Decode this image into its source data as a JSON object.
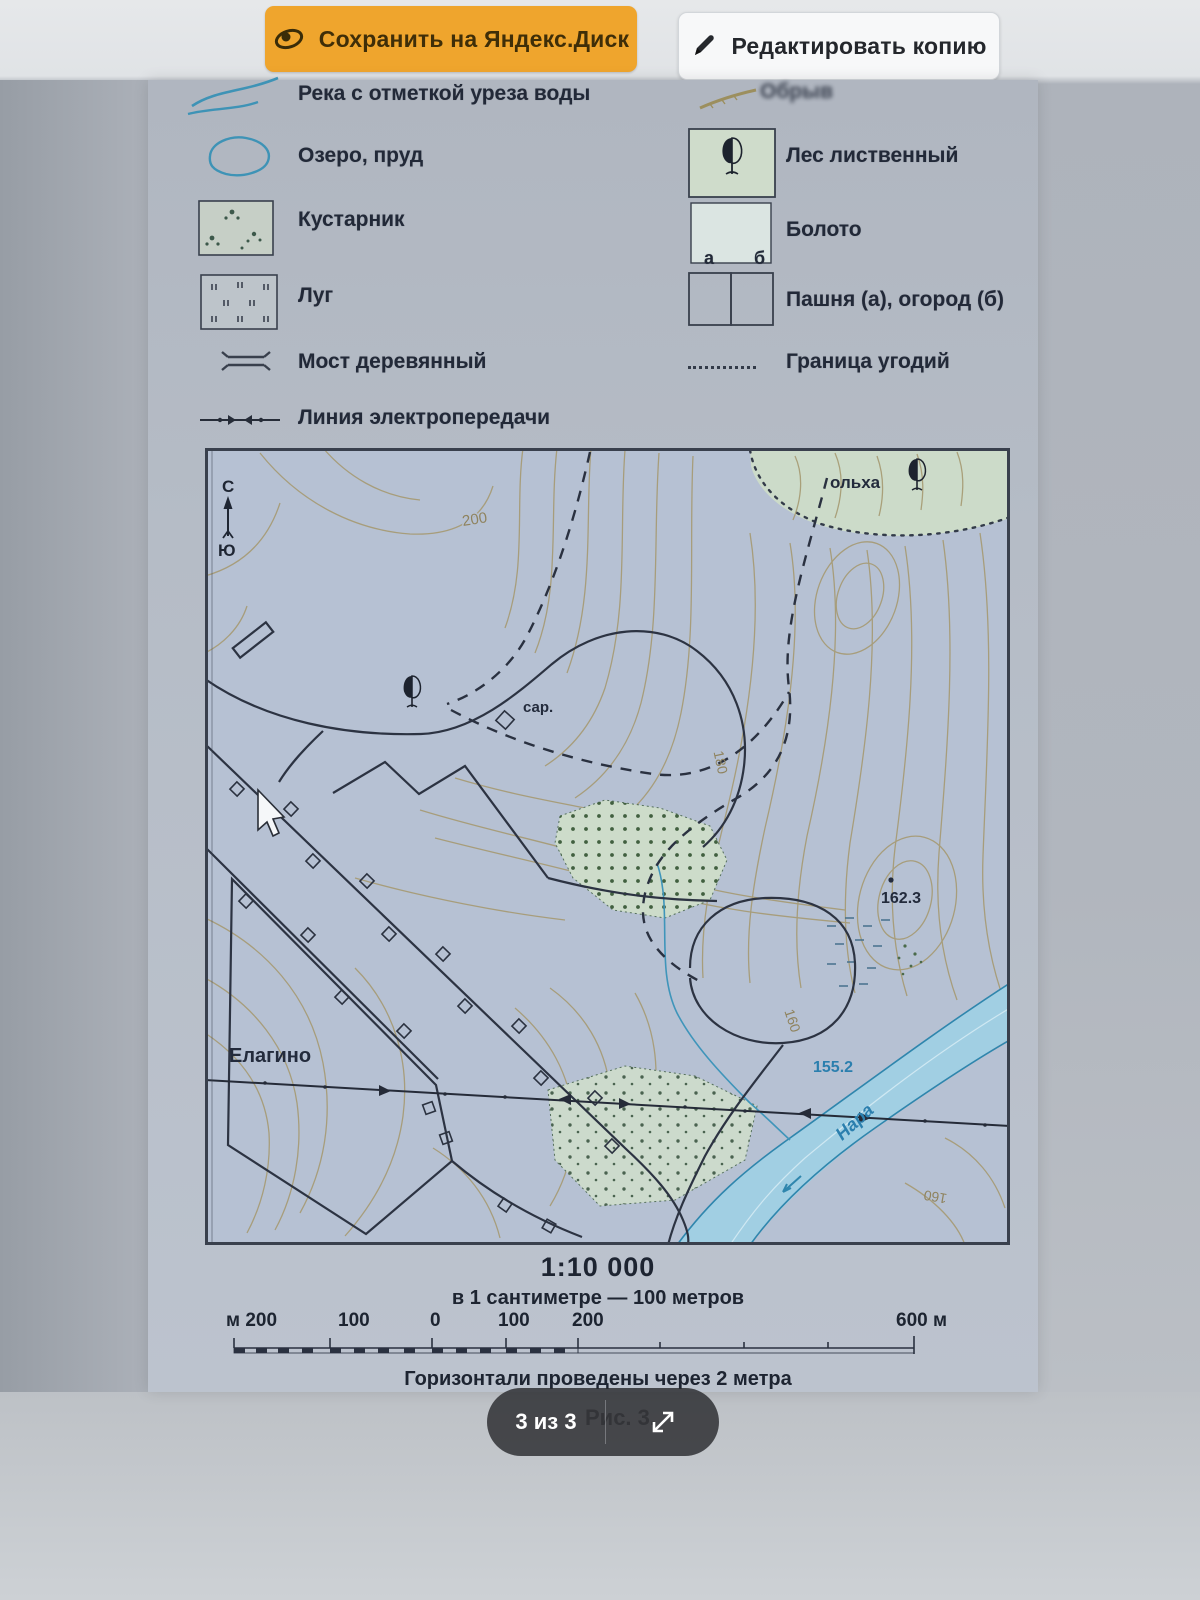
{
  "toolbar": {
    "save_label": "Сохранить на Яндекс.Диск",
    "edit_label": "Редактировать копию"
  },
  "legend": {
    "left": [
      {
        "label": "Река с отметкой уреза воды",
        "symbol": "river-lines"
      },
      {
        "label": "Озеро, пруд",
        "symbol": "lake-oval"
      },
      {
        "label": "Кустарник",
        "symbol": "shrub-box"
      },
      {
        "label": "Луг",
        "symbol": "meadow-box"
      },
      {
        "label": "Мост деревянный",
        "symbol": "wooden-bridge"
      },
      {
        "label": "Линия электропередачи",
        "symbol": "power-line"
      }
    ],
    "right": [
      {
        "label": "Обрыв",
        "symbol": "cliff-stroke"
      },
      {
        "label": "Лес лиственный",
        "symbol": "deciduous-forest-box"
      },
      {
        "label": "Болото",
        "symbol": "swamp-box"
      },
      {
        "label": "Пашня (а), огород (б)",
        "symbol": "field-garden-boxes",
        "sub_a": "а",
        "sub_b": "б"
      },
      {
        "label": "Граница угодий",
        "symbol": "land-boundary-dotted"
      }
    ]
  },
  "map": {
    "labels": {
      "north": "С",
      "south": "Ю",
      "contour_200": "200",
      "contour_180": "180",
      "contour_160_upper": "160",
      "contour_160_lower": "160",
      "alder": "ольха",
      "shed": "сар.",
      "spot_height": "162.3",
      "water_edge": "155.2",
      "village": "Елагино",
      "river": "Нара"
    }
  },
  "scale": {
    "ratio": "1:10 000",
    "note": "в 1 сантиметре — 100 метров",
    "bar_labels": [
      "м 200",
      "100",
      "0",
      "100",
      "200",
      "600 м"
    ],
    "contour_note": "Горизонтали проведены через 2 метра"
  },
  "figure": {
    "caption": "Рис. 3."
  },
  "pager": {
    "label": "3 из 3"
  },
  "colors": {
    "accent_orange": "#efa52d",
    "map_water": "#3e93b6",
    "map_contour": "#a2956b",
    "forest_fill": "#ccdac9"
  }
}
